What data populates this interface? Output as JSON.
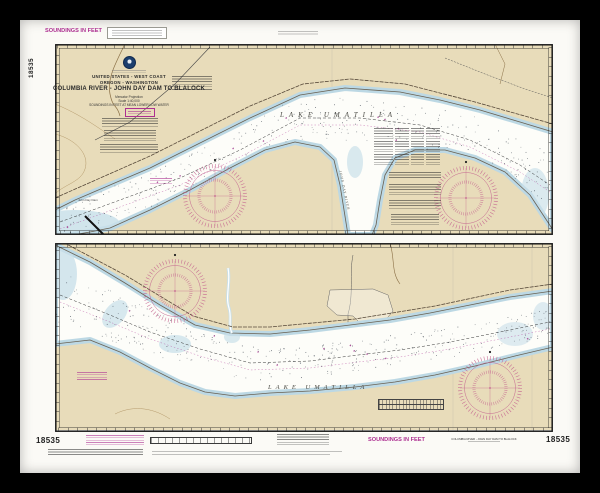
{
  "chart": {
    "number": "18535",
    "title": "COLUMBIA RIVER - JOHN DAY DAM TO BLALOCK",
    "authority_line": "UNITED STATES - WEST COAST",
    "region_line": "OREGON - WASHINGTON",
    "projection_line": "Mercator Projection",
    "scale_line": "Scale 1:40,000",
    "datum_line": "SOUNDINGS IN FEET AT MEAN LOWER LOW WATER",
    "soundings_label": "SOUNDINGS IN FEET"
  },
  "upper_panel": {
    "lake_label": "LAKE UMATILLA",
    "river_label": "JOHN DAY RIVER",
    "dam_label": "John Day Dam"
  },
  "lower_panel": {
    "lake_label": "LAKE UMATILLA"
  },
  "bottom_margin": {
    "number_left": "18535",
    "number_right": "18535",
    "soundings_label": "SOUNDINGS IN FEET",
    "small_title": "COLUMBIA RIVER - JOHN DAY DAM TO BLALOCK"
  },
  "colors": {
    "land": "#e8dcba",
    "water": "#fdfdf9",
    "shallow": "#c9e0ea",
    "rose_magenta": "#c4648f",
    "note_magenta": "#ad2f91"
  }
}
